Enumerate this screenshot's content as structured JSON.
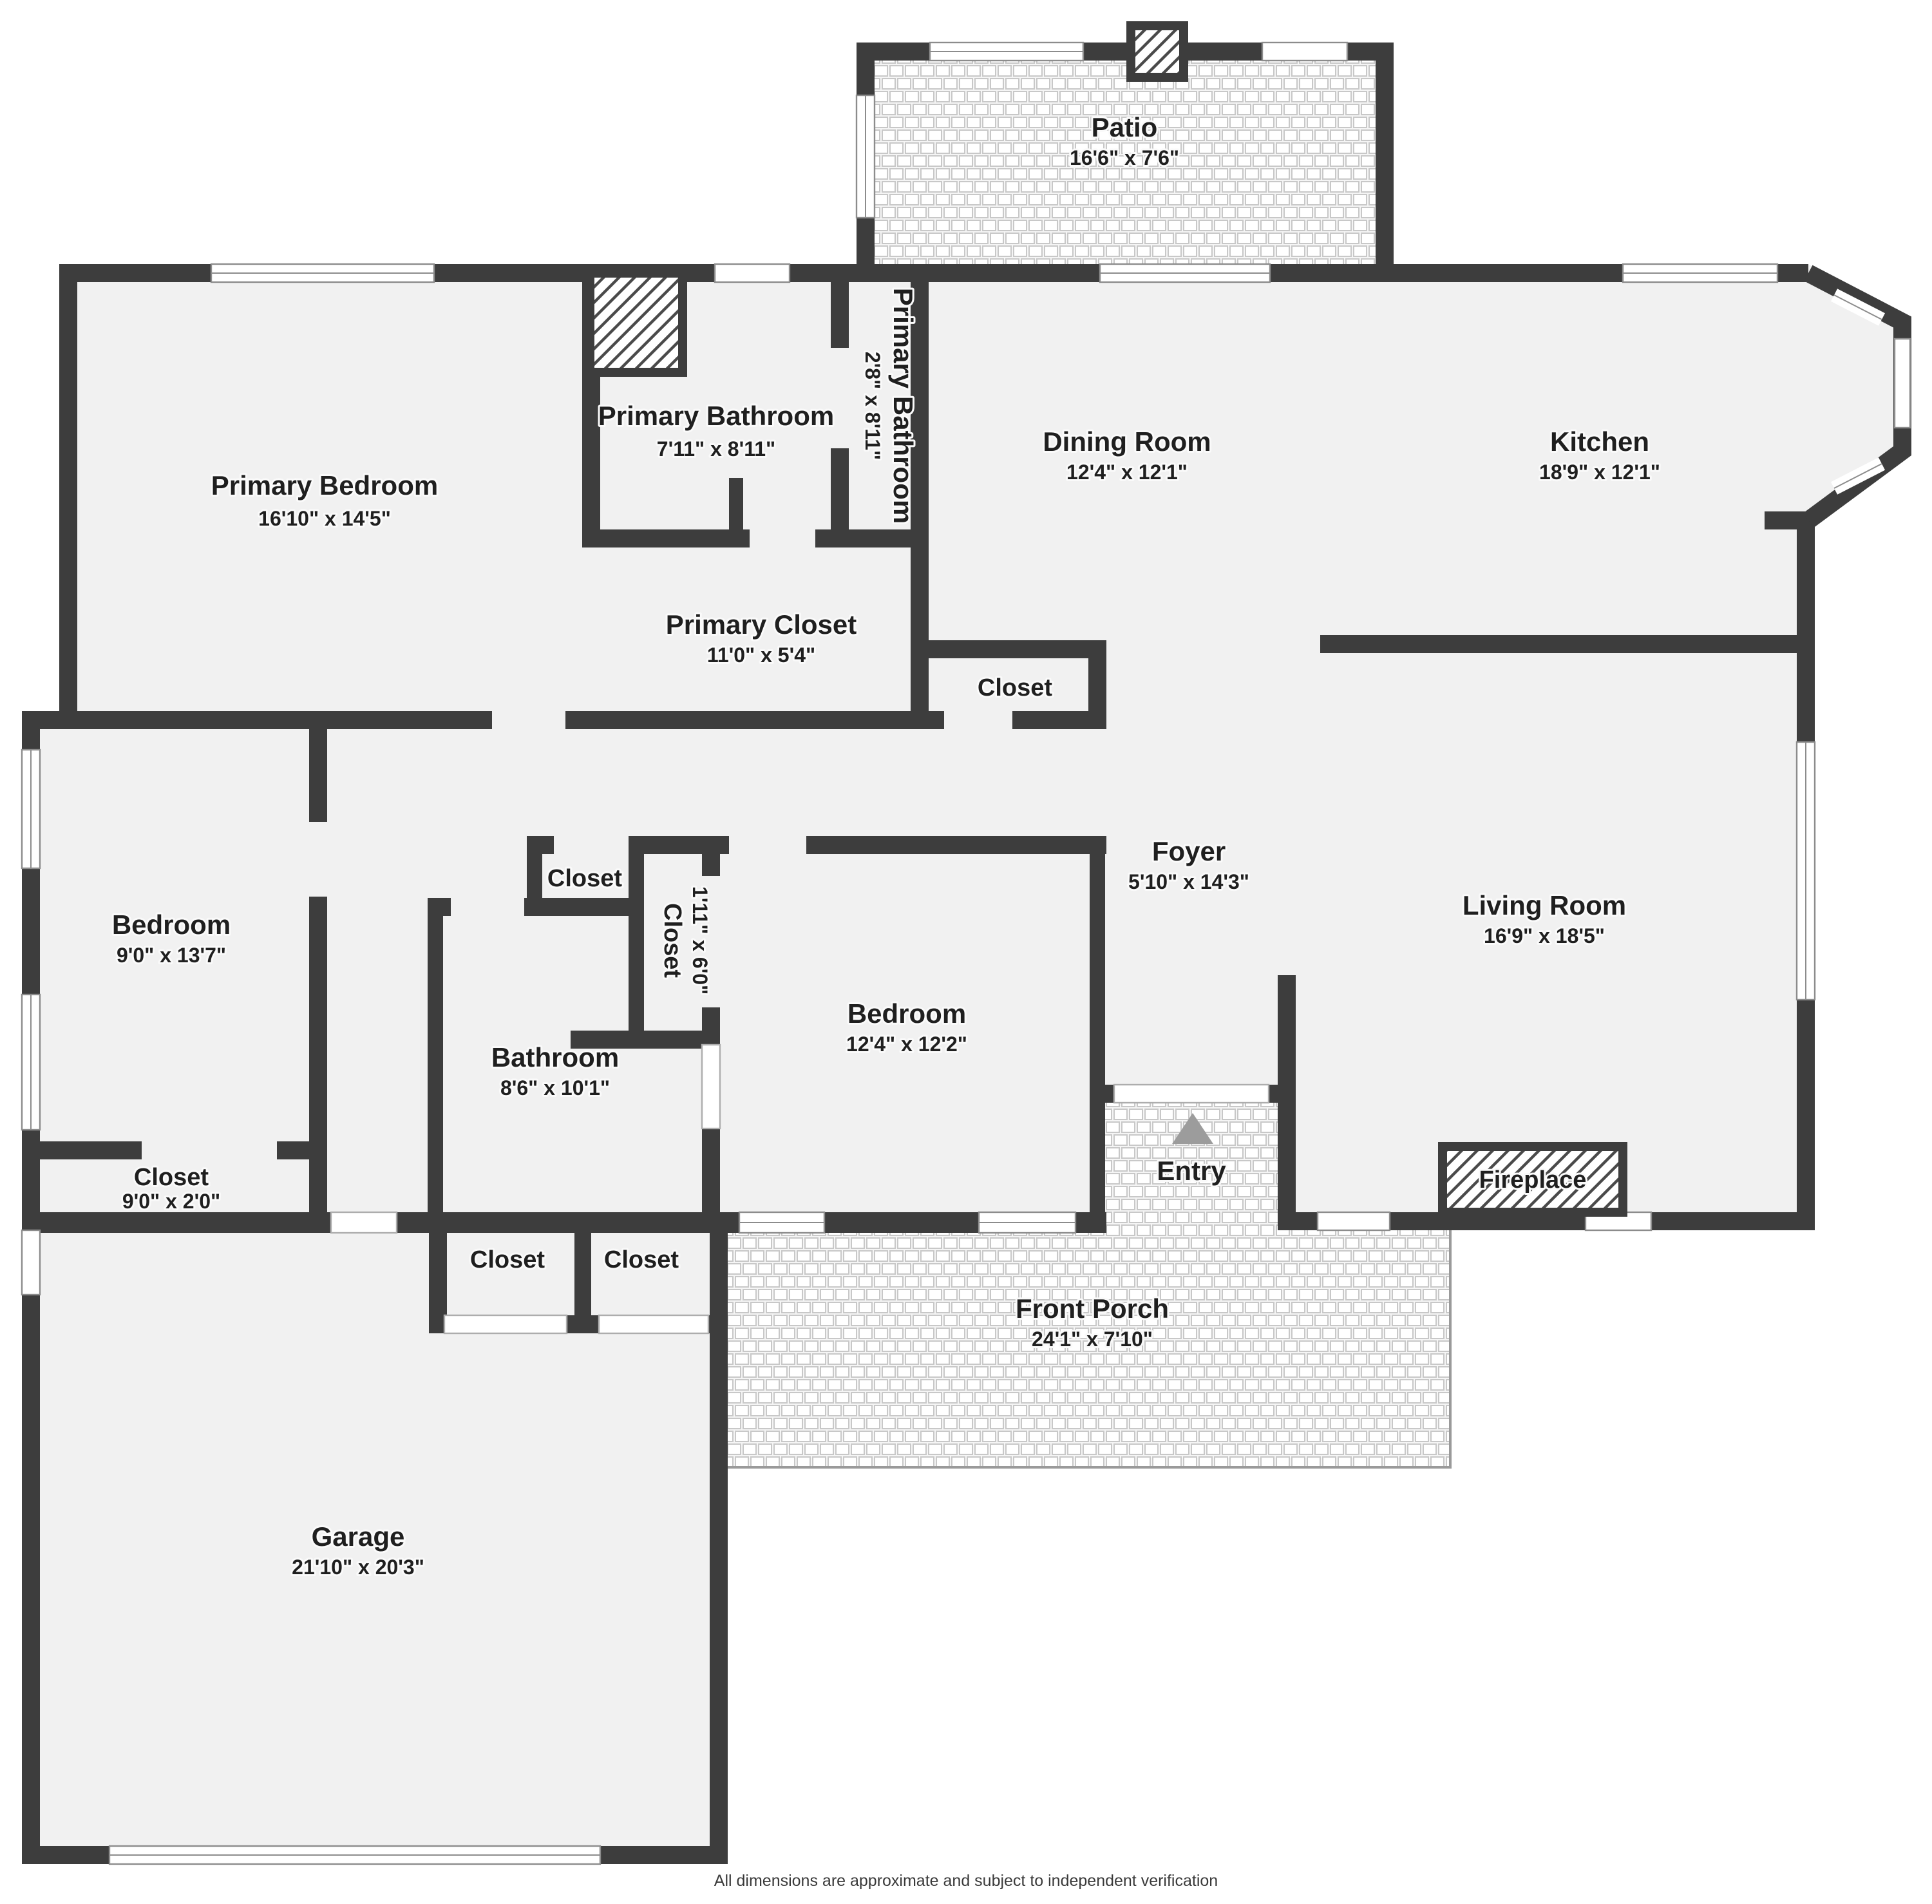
{
  "footer": "All dimensions are approximate and subject to independent verification",
  "colors": {
    "wall": "#3d3d3d",
    "floor": "#f1f1f1",
    "tile_line": "#c8c8c8",
    "label_text": "#1f1f1f",
    "entry_arrow": "#9c9c9c"
  },
  "rooms": {
    "patio": {
      "name": "Patio",
      "dims": "16'6\" x 7'6\""
    },
    "primary_bedroom": {
      "name": "Primary Bedroom",
      "dims": "16'10\" x 14'5\""
    },
    "primary_bathroom": {
      "name": "Primary Bathroom",
      "dims": "7'11\" x 8'11\""
    },
    "primary_bathroom_2": {
      "name": "Primary Bathroom",
      "dims": "2'8\" x 8'11\""
    },
    "dining_room": {
      "name": "Dining Room",
      "dims": "12'4\" x 12'1\""
    },
    "kitchen": {
      "name": "Kitchen",
      "dims": "18'9\" x 12'1\""
    },
    "primary_closet": {
      "name": "Primary Closet",
      "dims": "11'0\" x 5'4\""
    },
    "hall_closet": {
      "name": "Closet"
    },
    "bedroom_left": {
      "name": "Bedroom",
      "dims": "9'0\" x 13'7\""
    },
    "closet_left": {
      "name": "Closet",
      "dims": "9'0\" x 2'0\""
    },
    "closet_small": {
      "name": "Closet"
    },
    "closet_vertical": {
      "name": "Closet",
      "dims": "1'11\" x 6'0\""
    },
    "bathroom": {
      "name": "Bathroom",
      "dims": "8'6\" x 10'1\""
    },
    "bedroom_middle": {
      "name": "Bedroom",
      "dims": "12'4\" x 12'2\""
    },
    "foyer": {
      "name": "Foyer",
      "dims": "5'10\" x 14'3\""
    },
    "living_room": {
      "name": "Living Room",
      "dims": "16'9\" x 18'5\""
    },
    "entry": {
      "name": "Entry"
    },
    "fireplace": {
      "name": "Fireplace"
    },
    "front_porch": {
      "name": "Front Porch",
      "dims": "24'1\" x 7'10\""
    },
    "closet_garage_1": {
      "name": "Closet"
    },
    "closet_garage_2": {
      "name": "Closet"
    },
    "garage": {
      "name": "Garage",
      "dims": "21'10\" x 20'3\""
    }
  }
}
